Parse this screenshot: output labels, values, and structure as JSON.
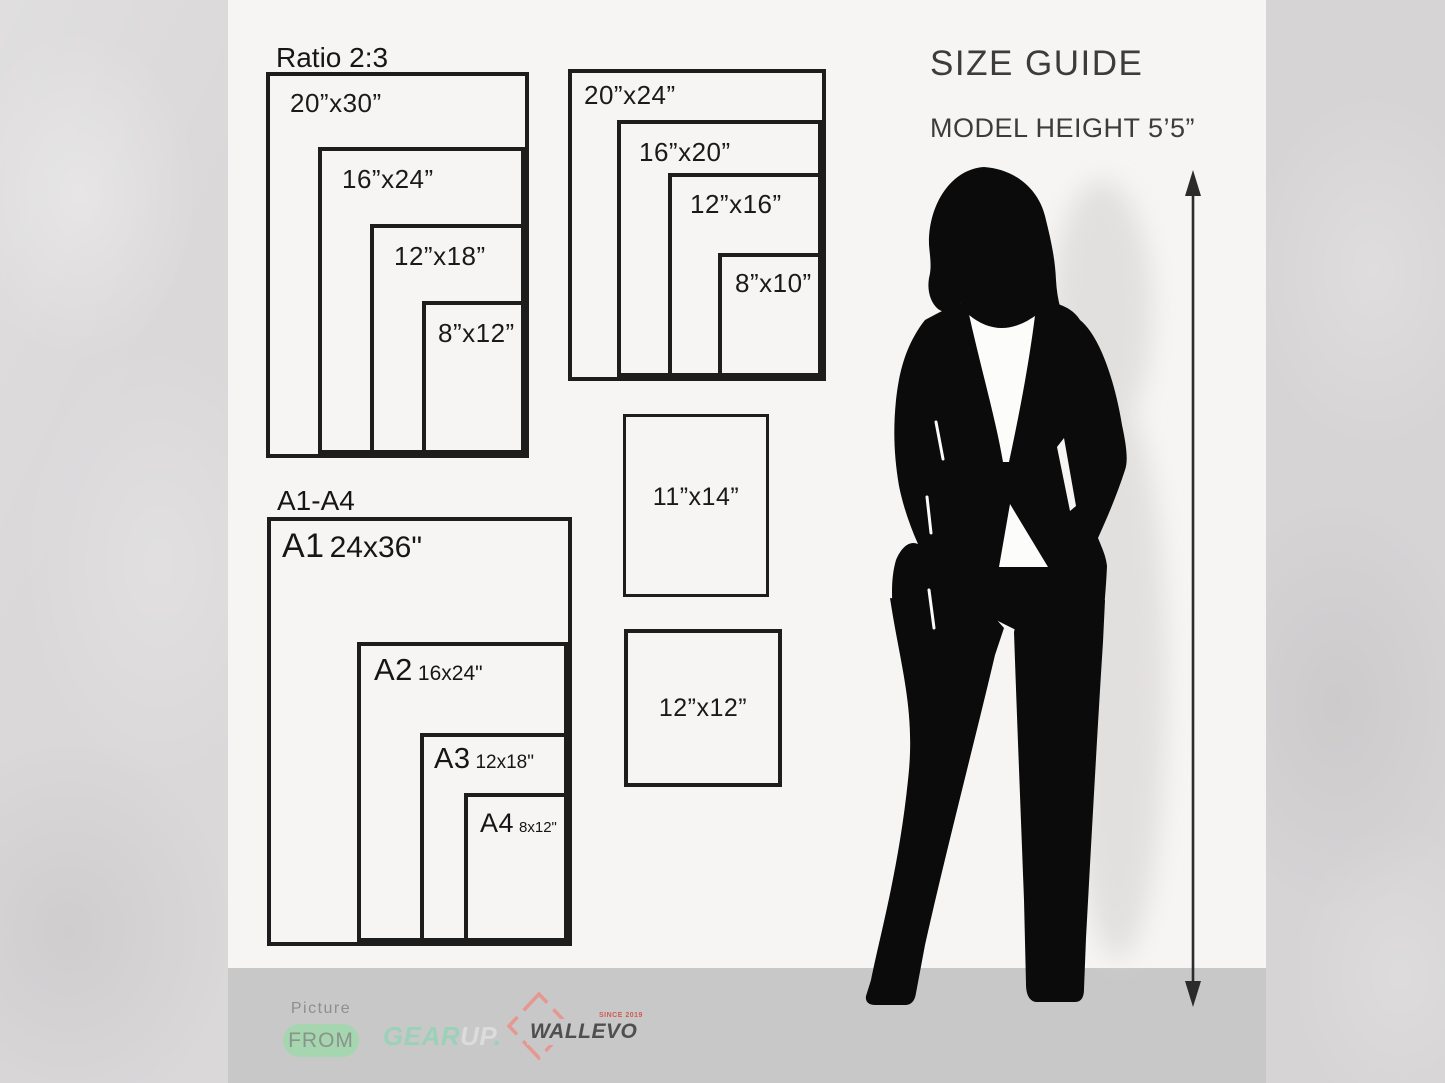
{
  "header": {
    "title": "SIZE GUIDE",
    "model_height": "MODEL HEIGHT 5’5”"
  },
  "ratio_group": {
    "title": "Ratio 2:3",
    "sizes": [
      "20”x30”",
      "16”x24”",
      "12”x18”",
      "8”x12”"
    ]
  },
  "standard_group": {
    "sizes": [
      "20”x24”",
      "16”x20”",
      "12”x16”",
      "8”x10”"
    ]
  },
  "a_group": {
    "title": "A1-A4",
    "sizes": [
      {
        "name": "A1",
        "inches": "24x36\""
      },
      {
        "name": "A2",
        "inches": "16x24\""
      },
      {
        "name": "A3",
        "inches": "12x18\""
      },
      {
        "name": "A4",
        "inches": "8x12\""
      }
    ]
  },
  "singles": [
    {
      "label": "11”x14”"
    },
    {
      "label": "12”x12”"
    }
  ],
  "footer": {
    "picture": "Picture",
    "from": "FROM",
    "gear": "GEAR",
    "up": "UP",
    "dot": ".",
    "wallevo": "WALLEVO",
    "since": "SINCE 2019"
  },
  "colors": {
    "accent_green": "#9bd1b8",
    "pill_green": "#a5d6b0",
    "logo_gray": "#4f4f4f",
    "diamond_red": "#e59790",
    "since_red": "#cf5a52",
    "band_gray": "#c9c8c9",
    "line_black": "#1d1d1d"
  }
}
